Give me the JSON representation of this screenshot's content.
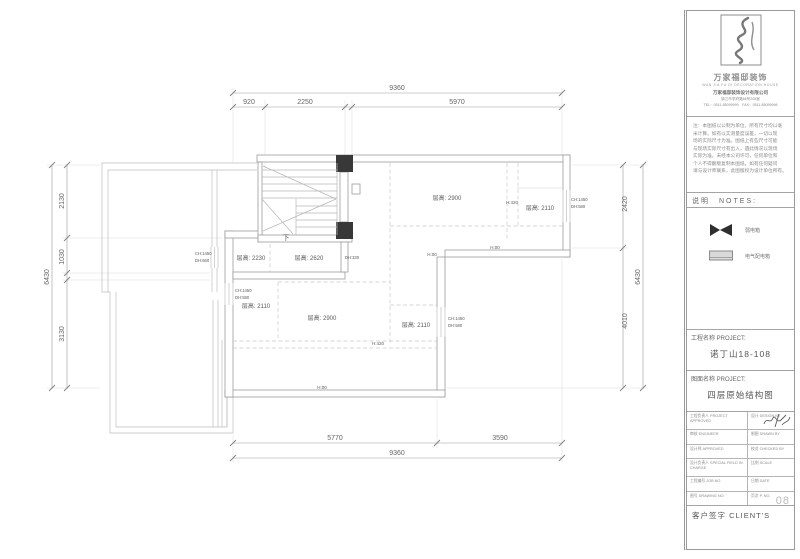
{
  "logo": {
    "brand": "万家福邸装饰",
    "brand_en": "WAN JIA FU DI DECORATION HOUSE",
    "company": "万家福邸装饰设计有限公司",
    "address": "镇江市学府路66号208室",
    "phone": "TEL：0511-85099999　FAX：0511-85099998"
  },
  "notes": {
    "header": "说明　NOTES:",
    "disclaimer_lines": [
      "注：本图纸以公制为单位，所有尺寸均以毫",
      "米计算。如有以实测量度误差，一切以现",
      "场的实际尺寸为准。图纸上有些尺寸可能",
      "与现场实际尺寸有出入，遇此情况以现场",
      "实际为准。未经本公司许可，任何单位和",
      "个人不得翻版复制本图纸。如有任何疑问",
      "请与设计师联系，此图版权为设计单位所有。"
    ]
  },
  "legend": {
    "items": [
      {
        "symbol": "bowtie",
        "label": "弱电箱"
      },
      {
        "symbol": "panel",
        "label": "电气配电箱"
      }
    ]
  },
  "title_block": {
    "project_label": "工程名称 PROJECT:",
    "project_value": "诺丁山18-108",
    "drawing_label": "图面名称 PROJECT:",
    "drawing_value": "四层原始结构图",
    "rows": [
      {
        "left": "工程负责人 PROJECT APPROVED",
        "right": "设计 DESIGN BY"
      },
      {
        "left": "审核 ENGINEER",
        "right": "制图 DRAWN BY"
      },
      {
        "left": "设计师 APPROVED",
        "right": "校对 CHECKED BY"
      },
      {
        "left": "设计负责人 SPECIAL FIELD IN CHARGE",
        "right": "比例 SCALE"
      },
      {
        "left": "工程编号 JOB NO.",
        "right": "日期 DATE"
      },
      {
        "left": "图号 DRAWING NO.",
        "right": "页次 P. NO."
      }
    ],
    "page_number": "08",
    "client_label": "客户签字 CLIENT'S"
  },
  "plan": {
    "room_labels": [
      {
        "t": "层高: 2900",
        "x": 447,
        "y": 200,
        "n": "room-height-label"
      },
      {
        "t": "H:420",
        "x": 512,
        "y": 204,
        "s": 4.5,
        "n": "level-label"
      },
      {
        "t": "层高: 2110",
        "x": 540,
        "y": 210,
        "n": "room-height-label"
      },
      {
        "t": "CH:1450",
        "x": 571,
        "y": 201,
        "s": 4.2,
        "a": "start",
        "n": "window-label"
      },
      {
        "t": "DH:580",
        "x": 571,
        "y": 208,
        "s": 4.2,
        "a": "start",
        "n": "window-label"
      },
      {
        "t": "H:00",
        "x": 495,
        "y": 249,
        "s": 4.5,
        "n": "level-label"
      },
      {
        "t": "H:00",
        "x": 432,
        "y": 256,
        "s": 4.5,
        "n": "level-label"
      },
      {
        "t": "CH:1450",
        "x": 195,
        "y": 255,
        "s": 4.2,
        "a": "start",
        "n": "window-label"
      },
      {
        "t": "DH:660",
        "x": 195,
        "y": 262,
        "s": 4.2,
        "a": "start",
        "n": "window-label"
      },
      {
        "t": "层高: 2230",
        "x": 251,
        "y": 260,
        "n": "room-height-label"
      },
      {
        "t": "层高: 2620",
        "x": 309,
        "y": 260,
        "n": "room-height-label"
      },
      {
        "t": "DH:330",
        "x": 352,
        "y": 259,
        "s": 4.2,
        "n": "window-label"
      },
      {
        "t": "CH:1450",
        "x": 235,
        "y": 292,
        "s": 4.2,
        "a": "start",
        "n": "window-label"
      },
      {
        "t": "DH:580",
        "x": 235,
        "y": 299,
        "s": 4.2,
        "a": "start",
        "n": "window-label"
      },
      {
        "t": "层高: 2110",
        "x": 256,
        "y": 308,
        "n": "room-height-label"
      },
      {
        "t": "层高: 2900",
        "x": 322,
        "y": 320,
        "n": "room-height-label"
      },
      {
        "t": "层高: 2110",
        "x": 416,
        "y": 327,
        "n": "room-height-label"
      },
      {
        "t": "CH:1450",
        "x": 448,
        "y": 320,
        "s": 4.2,
        "a": "start",
        "n": "window-label"
      },
      {
        "t": "DH:580",
        "x": 448,
        "y": 327,
        "s": 4.2,
        "a": "start",
        "n": "window-label"
      },
      {
        "t": "H:420",
        "x": 378,
        "y": 345,
        "s": 4.5,
        "n": "level-label"
      },
      {
        "t": "H:00",
        "x": 322,
        "y": 389,
        "s": 4.5,
        "n": "level-label"
      },
      {
        "t": "下",
        "x": 286,
        "y": 240,
        "s": 7,
        "n": "stair-down-label"
      }
    ],
    "dim_labels": [
      {
        "t": "9360",
        "x": 397,
        "y": 90,
        "n": "dim-top-total"
      },
      {
        "t": "920",
        "x": 249,
        "y": 104,
        "n": "dim-top"
      },
      {
        "t": "2250",
        "x": 305,
        "y": 104,
        "n": "dim-top"
      },
      {
        "t": "5970",
        "x": 457,
        "y": 104,
        "n": "dim-top"
      },
      {
        "t": "2130",
        "x": 64,
        "y": 201,
        "r": -90,
        "n": "dim-left"
      },
      {
        "t": "1030",
        "x": 64,
        "y": 257,
        "r": -90,
        "n": "dim-left"
      },
      {
        "t": "3130",
        "x": 64,
        "y": 334,
        "r": -90,
        "n": "dim-left"
      },
      {
        "t": "6430",
        "x": 49,
        "y": 277,
        "r": -90,
        "n": "dim-left-total"
      },
      {
        "t": "2420",
        "x": 627,
        "y": 204,
        "r": -90,
        "n": "dim-right"
      },
      {
        "t": "4010",
        "x": 627,
        "y": 321,
        "r": -90,
        "n": "dim-right"
      },
      {
        "t": "6430",
        "x": 640,
        "y": 277,
        "r": -90,
        "n": "dim-right-total"
      },
      {
        "t": "5770",
        "x": 335,
        "y": 440,
        "n": "dim-bottom"
      },
      {
        "t": "3590",
        "x": 500,
        "y": 440,
        "n": "dim-bottom"
      },
      {
        "t": "9360",
        "x": 397,
        "y": 455,
        "n": "dim-bottom-total"
      }
    ]
  }
}
